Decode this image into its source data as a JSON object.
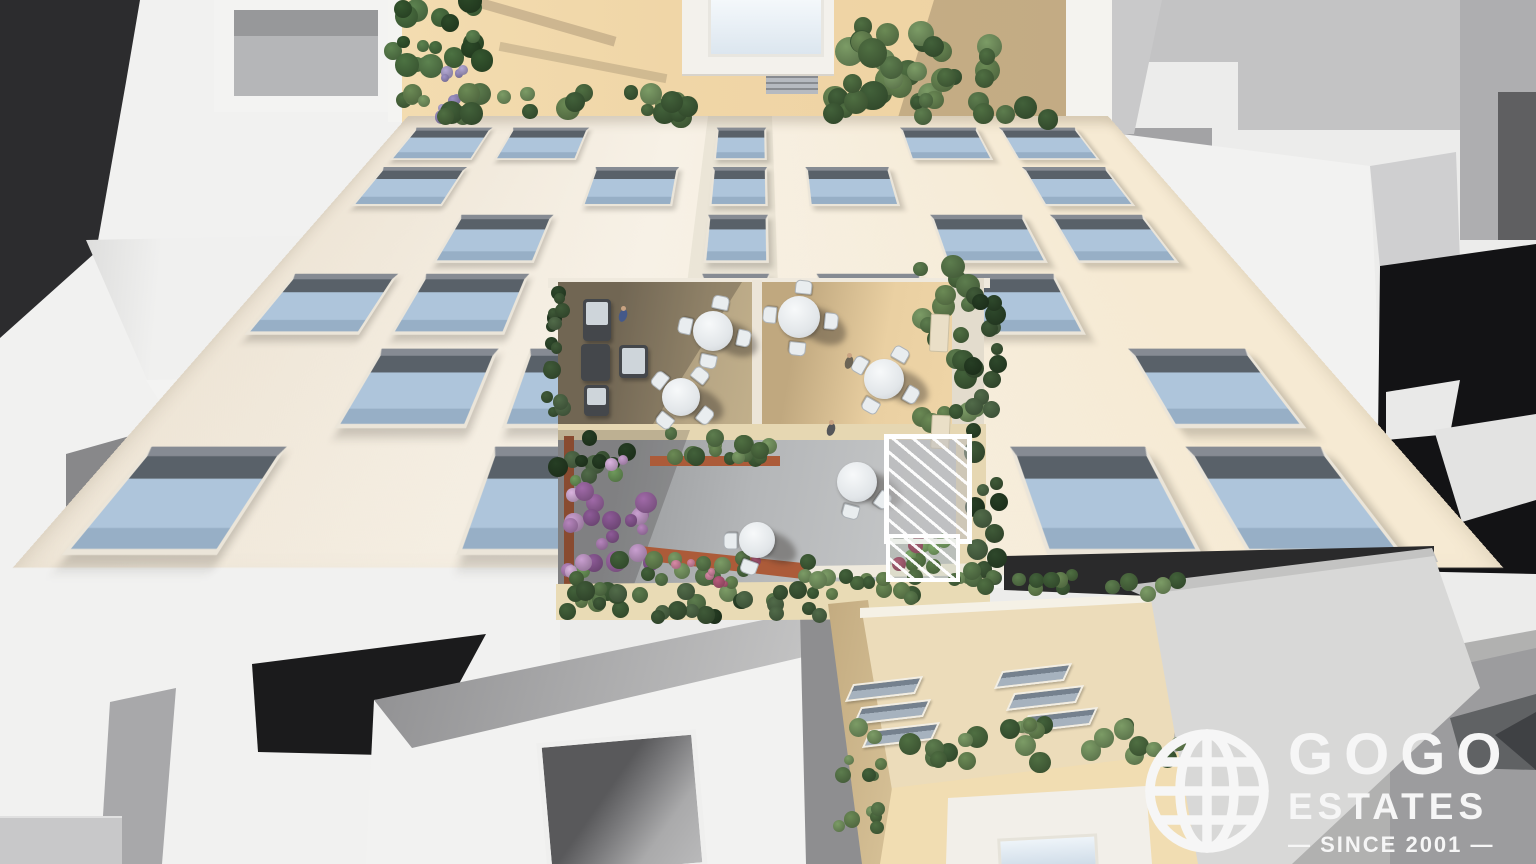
{
  "watermark": {
    "icon": "globe-wireframe-icon",
    "line1": "GOGO",
    "line2": "ESTATES",
    "tagline": "— SINCE 2001 —",
    "color": "#f6f6f6"
  },
  "scene": {
    "type": "aerial-3d-architectural-render",
    "palette": {
      "roof_terrace_tan": "#f0d6a7",
      "facade_white": "#f6f0e6",
      "window_glass_blue": "#aec5db",
      "terrace_wood_light": "#ead0a2",
      "terrace_wood_shadow": "#8d8069",
      "courtyard_stone": "#b4b6b8",
      "planter_terracotta": "#ac5b39",
      "vegetation_green": "#5d7c4f",
      "flower_purple": "#b685bd",
      "context_white": "#f1f1f0",
      "context_shadow_black": "#1a1a1b",
      "logo_white": "#f6f6f6"
    },
    "palettes": {
      "green": [
        "#6b8a55",
        "#4f6f42",
        "#7c9c66",
        "#42613a",
        "#5d7d4e"
      ],
      "darkgreen": [
        "#3f5a38",
        "#2e482b",
        "#516b49",
        "#263e24"
      ],
      "palm": [
        "#4c7242",
        "#35572f",
        "#5d8350",
        "#2c4a28"
      ],
      "purple": [
        "#b685bd",
        "#c99fd0",
        "#a06aa8",
        "#dab4df",
        "#8e5b98",
        "#6f9a5c"
      ],
      "pink": [
        "#c96b8e",
        "#b85a7b",
        "#d98aa6"
      ],
      "pinkgreen": [
        "#c96b8e",
        "#7fae6a",
        "#b85a7b",
        "#567a45"
      ],
      "lavender": [
        "#9d92c6",
        "#b3a8d4",
        "#7e74a8"
      ]
    },
    "vegetation": [
      {
        "name": "palm-tree",
        "x": 392,
        "y": 0,
        "w": 95,
        "h": 66,
        "n": 20,
        "rmin": 5,
        "rmax": 12,
        "p": "palm"
      },
      {
        "name": "lavender-plant",
        "x": 428,
        "y": 70,
        "w": 36,
        "h": 48,
        "n": 9,
        "rmin": 4,
        "rmax": 7,
        "p": "lavender"
      },
      {
        "name": "roof-hedge-left",
        "x": 402,
        "y": 88,
        "w": 288,
        "h": 30,
        "n": 26,
        "rmin": 6,
        "rmax": 12,
        "p": "green"
      },
      {
        "name": "roof-hedge-right",
        "x": 832,
        "y": 92,
        "w": 236,
        "h": 28,
        "n": 20,
        "rmin": 6,
        "rmax": 12,
        "p": "green"
      },
      {
        "name": "roof-tree-large",
        "x": 836,
        "y": 26,
        "w": 72,
        "h": 80,
        "n": 16,
        "rmin": 8,
        "rmax": 15,
        "p": "green"
      },
      {
        "name": "roof-tree-small",
        "x": 916,
        "y": 32,
        "w": 78,
        "h": 50,
        "n": 13,
        "rmin": 7,
        "rmax": 13,
        "p": "green"
      },
      {
        "name": "terrace-edge-plants",
        "x": 546,
        "y": 284,
        "w": 18,
        "h": 146,
        "n": 15,
        "rmin": 5,
        "rmax": 9,
        "p": "darkgreen"
      },
      {
        "name": "terrace-right-hedge",
        "x": 920,
        "y": 266,
        "w": 56,
        "h": 172,
        "n": 22,
        "rmin": 7,
        "rmax": 12,
        "p": "green"
      },
      {
        "name": "ivy-wall",
        "x": 972,
        "y": 295,
        "w": 32,
        "h": 290,
        "n": 26,
        "rmin": 6,
        "rmax": 11,
        "p": "darkgreen"
      },
      {
        "name": "courtyard-planter",
        "x": 650,
        "y": 428,
        "w": 128,
        "h": 32,
        "n": 16,
        "rmin": 6,
        "rmax": 10,
        "p": "green"
      },
      {
        "name": "flowerbed-green-top",
        "x": 558,
        "y": 436,
        "w": 72,
        "h": 42,
        "n": 10,
        "rmin": 6,
        "rmax": 10,
        "p": "darkgreen"
      },
      {
        "name": "flowerbed-purple",
        "x": 564,
        "y": 452,
        "w": 88,
        "h": 120,
        "n": 28,
        "rmin": 5,
        "rmax": 11,
        "p": "purple"
      },
      {
        "name": "flowerbed-green-bottom",
        "x": 564,
        "y": 556,
        "w": 84,
        "h": 60,
        "n": 12,
        "rmin": 6,
        "rmax": 10,
        "p": "green"
      },
      {
        "name": "planter-row-mid",
        "x": 646,
        "y": 554,
        "w": 168,
        "h": 50,
        "n": 18,
        "rmin": 6,
        "rmax": 10,
        "p": "green"
      },
      {
        "name": "planter-flowers-mid",
        "x": 676,
        "y": 558,
        "w": 92,
        "h": 30,
        "n": 7,
        "rmin": 3,
        "rmax": 6,
        "p": "pink"
      },
      {
        "name": "walkway-hedge",
        "x": 584,
        "y": 590,
        "w": 238,
        "h": 28,
        "n": 18,
        "rmin": 6,
        "rmax": 10,
        "p": "darkgreen"
      },
      {
        "name": "pergola-garden",
        "x": 886,
        "y": 532,
        "w": 62,
        "h": 36,
        "n": 12,
        "rmin": 5,
        "rmax": 8,
        "p": "pinkgreen"
      },
      {
        "name": "bottom-hedge-left",
        "x": 812,
        "y": 576,
        "w": 116,
        "h": 30,
        "n": 13,
        "rmin": 6,
        "rmax": 10,
        "p": "green"
      },
      {
        "name": "bottom-hedge-right",
        "x": 938,
        "y": 570,
        "w": 246,
        "h": 28,
        "n": 20,
        "rmin": 6,
        "rmax": 10,
        "p": "green"
      },
      {
        "name": "bottom-hedge-diagonal",
        "x": 854,
        "y": 724,
        "w": 330,
        "h": 46,
        "n": 28,
        "rmin": 6,
        "rmax": 11,
        "p": "green"
      },
      {
        "name": "bottom-left-shrubs",
        "x": 836,
        "y": 752,
        "w": 44,
        "h": 84,
        "n": 10,
        "rmin": 5,
        "rmax": 9,
        "p": "green"
      }
    ],
    "facade_windows": {
      "cols_x": [
        18,
        112,
        206,
        310,
        392,
        488,
        584
      ],
      "col_w": [
        70,
        70,
        70,
        44,
        70,
        70,
        70
      ],
      "rows_y": [
        16,
        64,
        112,
        160,
        208,
        256
      ],
      "win_h": 34,
      "grid": [
        [
          1,
          1,
          0,
          1,
          0,
          1,
          1
        ],
        [
          1,
          0,
          1,
          1,
          1,
          0,
          1
        ],
        [
          0,
          1,
          0,
          1,
          0,
          1,
          1
        ],
        [
          1,
          1,
          0,
          1,
          1,
          1,
          0
        ],
        [
          0,
          1,
          1,
          0,
          1,
          0,
          1
        ],
        [
          1,
          0,
          1,
          1,
          0,
          1,
          1
        ]
      ]
    },
    "tables": [
      {
        "name": "terrace-table-1",
        "x": 713,
        "y": 331,
        "r": 20,
        "chairs": 4,
        "rot": 12
      },
      {
        "name": "terrace-table-2",
        "x": 681,
        "y": 397,
        "r": 19,
        "chairs": 4,
        "rot": 38
      },
      {
        "name": "terrace-table-3",
        "x": 799,
        "y": 317,
        "r": 21,
        "chairs": 4,
        "rot": 6
      },
      {
        "name": "terrace-table-4",
        "x": 884,
        "y": 379,
        "r": 20,
        "chairs": 4,
        "rot": 30
      },
      {
        "name": "courtyard-table-1",
        "x": 757,
        "y": 540,
        "r": 18,
        "chairs": 2,
        "rot": 200
      },
      {
        "name": "courtyard-table-2",
        "x": 857,
        "y": 482,
        "r": 20,
        "chairs": 2,
        "rot": 125
      }
    ],
    "sofas": [
      {
        "name": "lounge-sofa-1",
        "x": 583,
        "y": 299,
        "w": 28,
        "h": 42,
        "cushion": 1
      },
      {
        "name": "lounge-ottoman",
        "x": 581,
        "y": 344,
        "w": 29,
        "h": 37,
        "cushion": 0
      },
      {
        "name": "lounge-side-table",
        "x": 619,
        "y": 345,
        "w": 29,
        "h": 33,
        "cushion": 2
      },
      {
        "name": "lounge-sofa-2",
        "x": 584,
        "y": 385,
        "w": 25,
        "h": 31,
        "cushion": 1
      }
    ],
    "people": [
      {
        "name": "person-sitting",
        "x": 619,
        "y": 309,
        "c": "#44598a"
      },
      {
        "name": "person-standing-1",
        "x": 845,
        "y": 356,
        "c": "#6b6455"
      },
      {
        "name": "person-standing-2",
        "x": 827,
        "y": 423,
        "c": "#55565a"
      }
    ],
    "benches": [
      {
        "name": "terrace-bench-1",
        "x": 930,
        "y": 314,
        "w": 17,
        "h": 36
      },
      {
        "name": "terrace-bench-2",
        "x": 931,
        "y": 415,
        "w": 17,
        "h": 32
      }
    ],
    "bottom_building_windows": {
      "w": 62,
      "items": [
        {
          "x": 851,
          "y": 680
        },
        {
          "x": 859,
          "y": 703
        },
        {
          "x": 868,
          "y": 726
        },
        {
          "x": 1000,
          "y": 667
        },
        {
          "x": 1012,
          "y": 689
        },
        {
          "x": 1026,
          "y": 711
        }
      ]
    }
  }
}
